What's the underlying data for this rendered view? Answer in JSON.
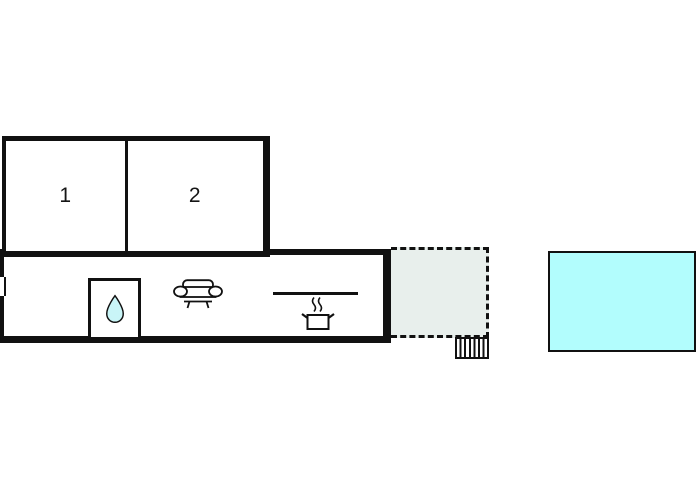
{
  "plan": {
    "type": "vacation-home-floor-plan",
    "rooms": [
      {
        "label": "1"
      },
      {
        "label": "2"
      }
    ],
    "icons": {
      "bathroom": "water-drop-icon",
      "living_area": "sofa-icon",
      "kitchen": "stove-pot-icon",
      "kitchen_counter": "counter-line",
      "outdoor": "stairs-icon",
      "wall_opening": "window-icon"
    },
    "areas": {
      "terrace": "dashed-outline-area",
      "pool": "water-filled-rectangle"
    }
  },
  "colors": {
    "wall": "#111111",
    "background": "#ffffff",
    "pool_fill": "#b2fdfd",
    "drop_fill": "#c9f5f7",
    "terrace_fill": "#e8efec"
  }
}
